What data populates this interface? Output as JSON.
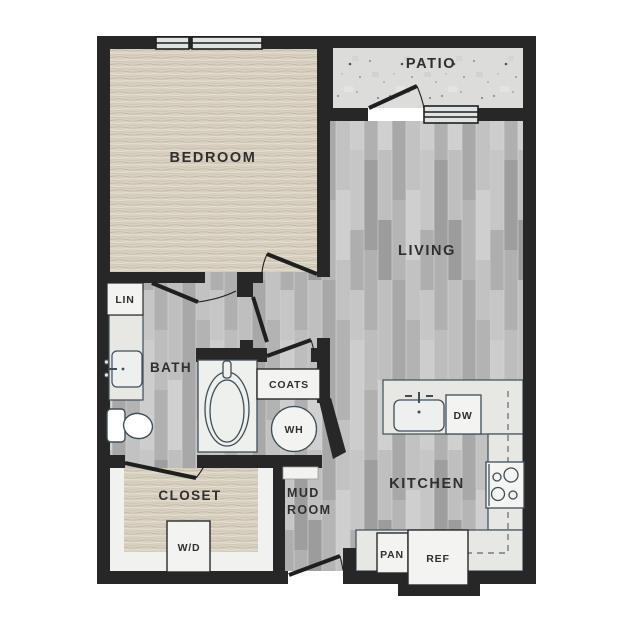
{
  "rooms": {
    "bedroom": "BEDROOM",
    "patio": "PATIO",
    "living": "LIVING",
    "kitchen": "KITCHEN",
    "bath": "BATH",
    "closet": "CLOSET",
    "mud_room_line1": "MUD",
    "mud_room_line2": "ROOM"
  },
  "fixtures": {
    "linen": "LIN",
    "coats": "COATS",
    "water_heater": "WH",
    "washer_dryer": "W/D",
    "dishwasher": "DW",
    "pantry": "PAN",
    "refrigerator": "REF"
  },
  "colors": {
    "wall": "#272727",
    "carpet": "#d9d2c3",
    "plank_floor": "#b9b9b9",
    "patio_concrete": "#dcdcda",
    "counter": "#e7e7e3",
    "fixture_fill": "#f3f4f2",
    "fixture_stroke": "#3e4e57",
    "label_text": "#2f2f2f",
    "dashed_cabinet": "#6f7e85"
  }
}
